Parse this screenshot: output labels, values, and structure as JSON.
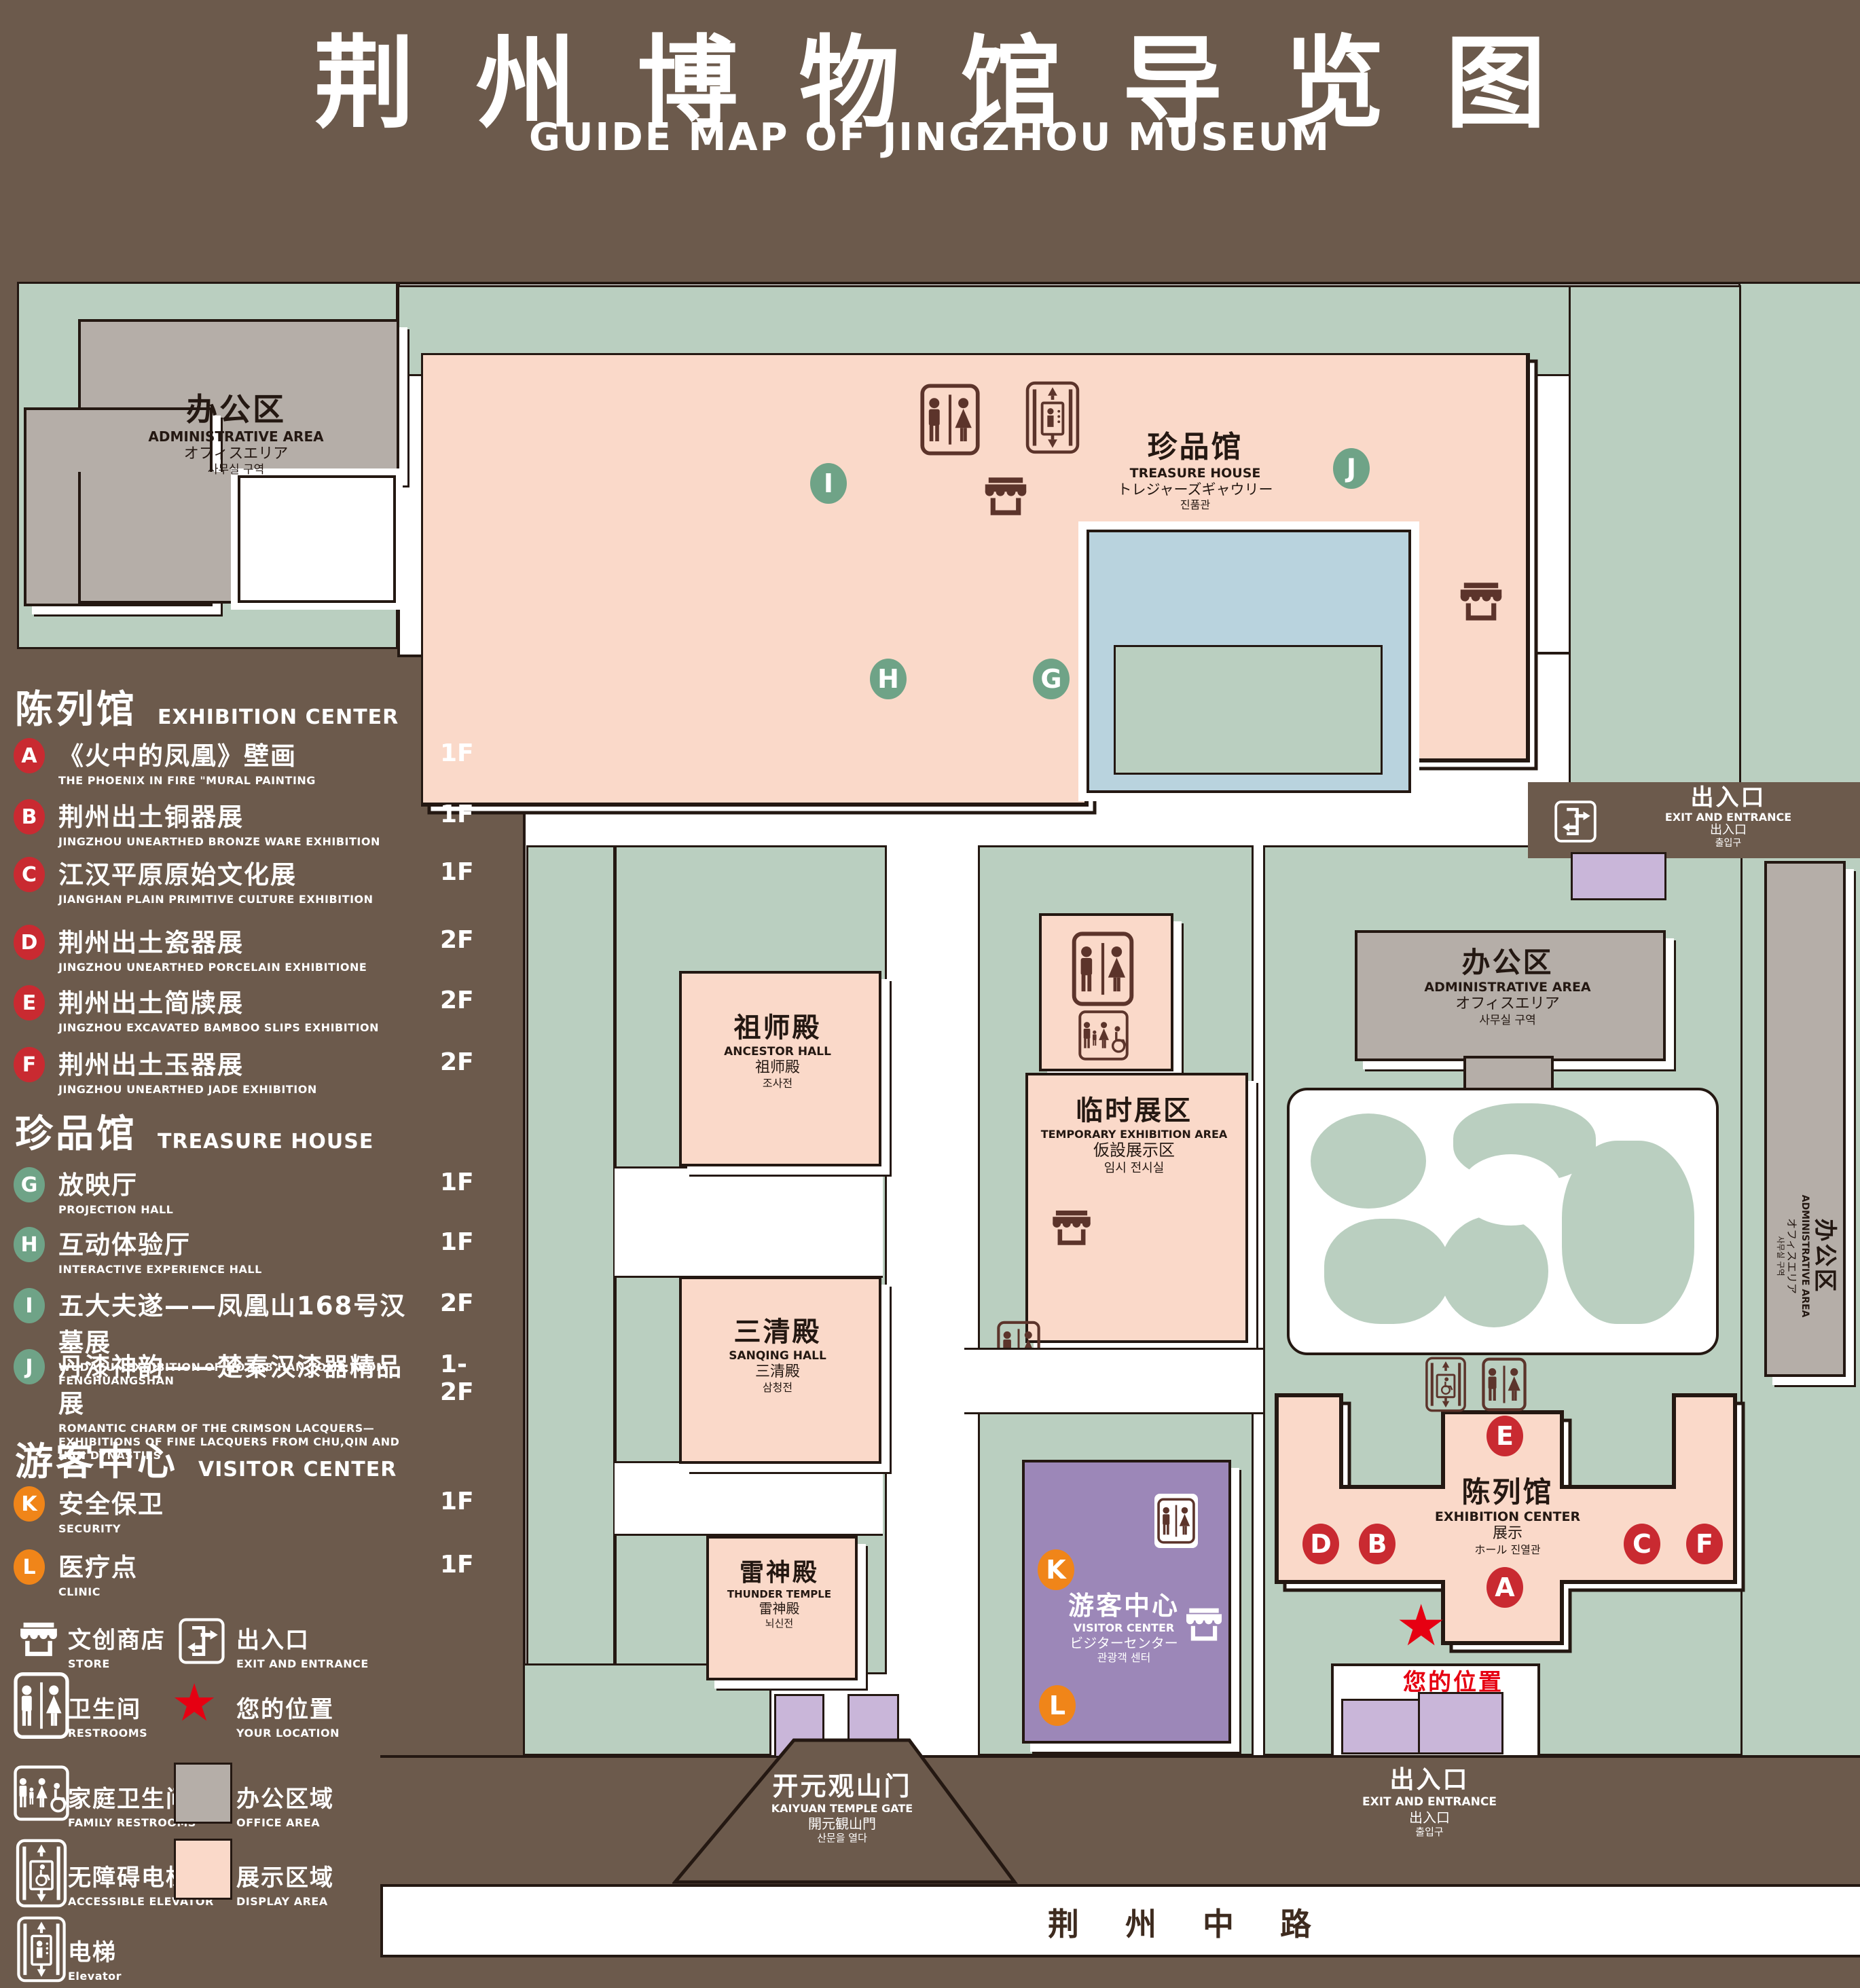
{
  "title": {
    "zh": "荆州博物馆导览图",
    "en": "GUIDE MAP OF JINGZHOU MUSEUM"
  },
  "legend": {
    "sections": [
      {
        "title_zh": "陈列馆",
        "title_en": "EXHIBITION CENTER",
        "items": [
          {
            "letter": "A",
            "zh": "《火中的凤凰》壁画",
            "en": "THE PHOENIX IN FIRE \"MURAL PAINTING",
            "floor": "1F"
          },
          {
            "letter": "B",
            "zh": "荆州出土铜器展",
            "en": "JINGZHOU UNEARTHED BRONZE WARE EXHIBITION",
            "floor": "1F"
          },
          {
            "letter": "C",
            "zh": "江汉平原原始文化展",
            "en": "JIANGHAN PLAIN PRIMITIVE CULTURE EXHIBITION",
            "floor": "1F"
          },
          {
            "letter": "D",
            "zh": "荆州出土瓷器展",
            "en": "JINGZHOU UNEARTHED PORCELAIN EXHIBITIONE",
            "floor": "2F"
          },
          {
            "letter": "E",
            "zh": "荆州出土简牍展",
            "en": "JINGZHOU EXCAVATED BAMBOO SLIPS EXHIBITION",
            "floor": "2F"
          },
          {
            "letter": "F",
            "zh": "荆州出土玉器展",
            "en": "JINGZHOU UNEARTHED JADE EXHIBITION",
            "floor": "2F"
          }
        ]
      },
      {
        "title_zh": "珍品馆",
        "title_en": "TREASURE HOUSE",
        "items": [
          {
            "letter": "G",
            "zh": "放映厅",
            "en": "PROJECTION HALL",
            "floor": "1F"
          },
          {
            "letter": "H",
            "zh": "互动体验厅",
            "en": "INTERACTIVE EXPERIENCE HALL",
            "floor": "1F"
          },
          {
            "letter": "I",
            "zh": "五大夫遂——凤凰山168号汉墓展",
            "en": "WUDAFU—EXHIBITION OF NO.168 HAN TOMB FROM FENGHUANGSHAN",
            "floor": "2F"
          },
          {
            "letter": "J",
            "zh": "丹漆神韵——楚秦汉漆器精品展",
            "en": "ROMANTIC CHARM OF THE CRIMSON LACQUERS—EXHIBITIONS OF FINE LACQUERS FROM CHU,QIN AND HAN DYNASTIES",
            "floor": "1-2F"
          }
        ]
      },
      {
        "title_zh": "游客中心",
        "title_en": "VISITOR CENTER",
        "items": [
          {
            "letter": "K",
            "zh": "安全保卫",
            "en": "SECURITY",
            "floor": "1F"
          },
          {
            "letter": "L",
            "zh": "医疗点",
            "en": "CLINIC",
            "floor": "1F"
          }
        ]
      }
    ],
    "symbols": [
      {
        "zh": "文创商店",
        "en": "STORE"
      },
      {
        "zh": "出入口",
        "en": "EXIT AND ENTRANCE"
      },
      {
        "zh": "卫生间",
        "en": "RESTROOMS"
      },
      {
        "zh": "您的位置",
        "en": "YOUR LOCATION"
      },
      {
        "zh": "家庭卫生间",
        "en": "FAMILY RESTROOMS"
      },
      {
        "zh": "办公区域",
        "en": "OFFICE AREA"
      },
      {
        "zh": "无障碍电梯",
        "en": "ACCESSIBLE ELEVATOR"
      },
      {
        "zh": "展示区域",
        "en": "DISPLAY AREA"
      },
      {
        "zh": "电梯",
        "en": "Elevator"
      }
    ],
    "star_char": "★"
  },
  "map": {
    "buildings": {
      "admin_nw": {
        "zh": "办公区",
        "en": "ADMINISTRATIVE AREA",
        "ja": "オフィスエリア",
        "ko": "사무실 구역"
      },
      "treasure": {
        "zh": "珍品馆",
        "en": "TREASURE HOUSE",
        "ja": "トレジャーズギャウリー",
        "ko": "진품관"
      },
      "ancestor": {
        "zh": "祖师殿",
        "en": "ANCESTOR HALL",
        "zh2": "祖师殿",
        "ko": "조사전"
      },
      "temporary": {
        "zh": "临时展区",
        "en": "TEMPORARY EXHIBITION AREA",
        "ja": "仮設展示区",
        "ko": "임시 전시실"
      },
      "sanqing": {
        "zh": "三清殿",
        "en": "SANQING HALL",
        "zh2": "三清殿",
        "ko": "삼청전"
      },
      "thunder": {
        "zh": "雷神殿",
        "en": "THUNDER TEMPLE",
        "zh2": "雷神殿",
        "ko": "뇌신전"
      },
      "admin_e": {
        "zh": "办公区",
        "en": "ADMINISTRATIVE AREA",
        "ja": "オフィスエリア",
        "ko": "사무실 구역"
      },
      "admin_strip": {
        "zh": "办公区",
        "en": "ADMINISTRATIVE AREA",
        "ja": "オフィスエリア",
        "ko": "사무실 구역"
      },
      "visitor": {
        "zh": "游客中心",
        "en": "VISITOR CENTER",
        "ja": "ビジターセンター",
        "ko": "관광객 센터"
      },
      "exhibition": {
        "zh": "陈列馆",
        "en": "EXHIBITION CENTER",
        "l3": "展示",
        "l4": "ホール 진열관"
      },
      "gate": {
        "zh": "开元观山门",
        "en": "KAIYUAN TEMPLE GATE",
        "ja": "開元観山門",
        "ko": "산문을 열다"
      }
    },
    "exits": {
      "northeast": {
        "zh": "出入口",
        "en": "EXIT AND ENTRANCE",
        "ja": "出入口",
        "ko": "출입구"
      },
      "south": {
        "zh": "出入口",
        "en": "EXIT AND ENTRANCE",
        "ja": "出入口",
        "ko": "출입구"
      }
    },
    "markers": {
      "A": "A",
      "B": "B",
      "C": "C",
      "D": "D",
      "E": "E",
      "F": "F",
      "G": "G",
      "H": "H",
      "I": "I",
      "J": "J",
      "K": "K",
      "L": "L"
    },
    "your_location": "您的位置",
    "your_location_star": "★",
    "road": "荆 州 中 路"
  },
  "colors": {
    "background": "#6C5A4C",
    "map_green": "#BACFC0",
    "display_area_pink": "#FAD9C9",
    "office_area_gray": "#B5AEA8",
    "pond_blue": "#B9D3DE",
    "visitor_purple": "#9C87B8",
    "gate_purple": "#C9B6D9",
    "marker_red": "#C92A31",
    "marker_green": "#6FA387",
    "marker_orange": "#F08519",
    "star_red": "#E60012",
    "outline_dark": "#241812",
    "icon_maroon": "#5C342B"
  }
}
